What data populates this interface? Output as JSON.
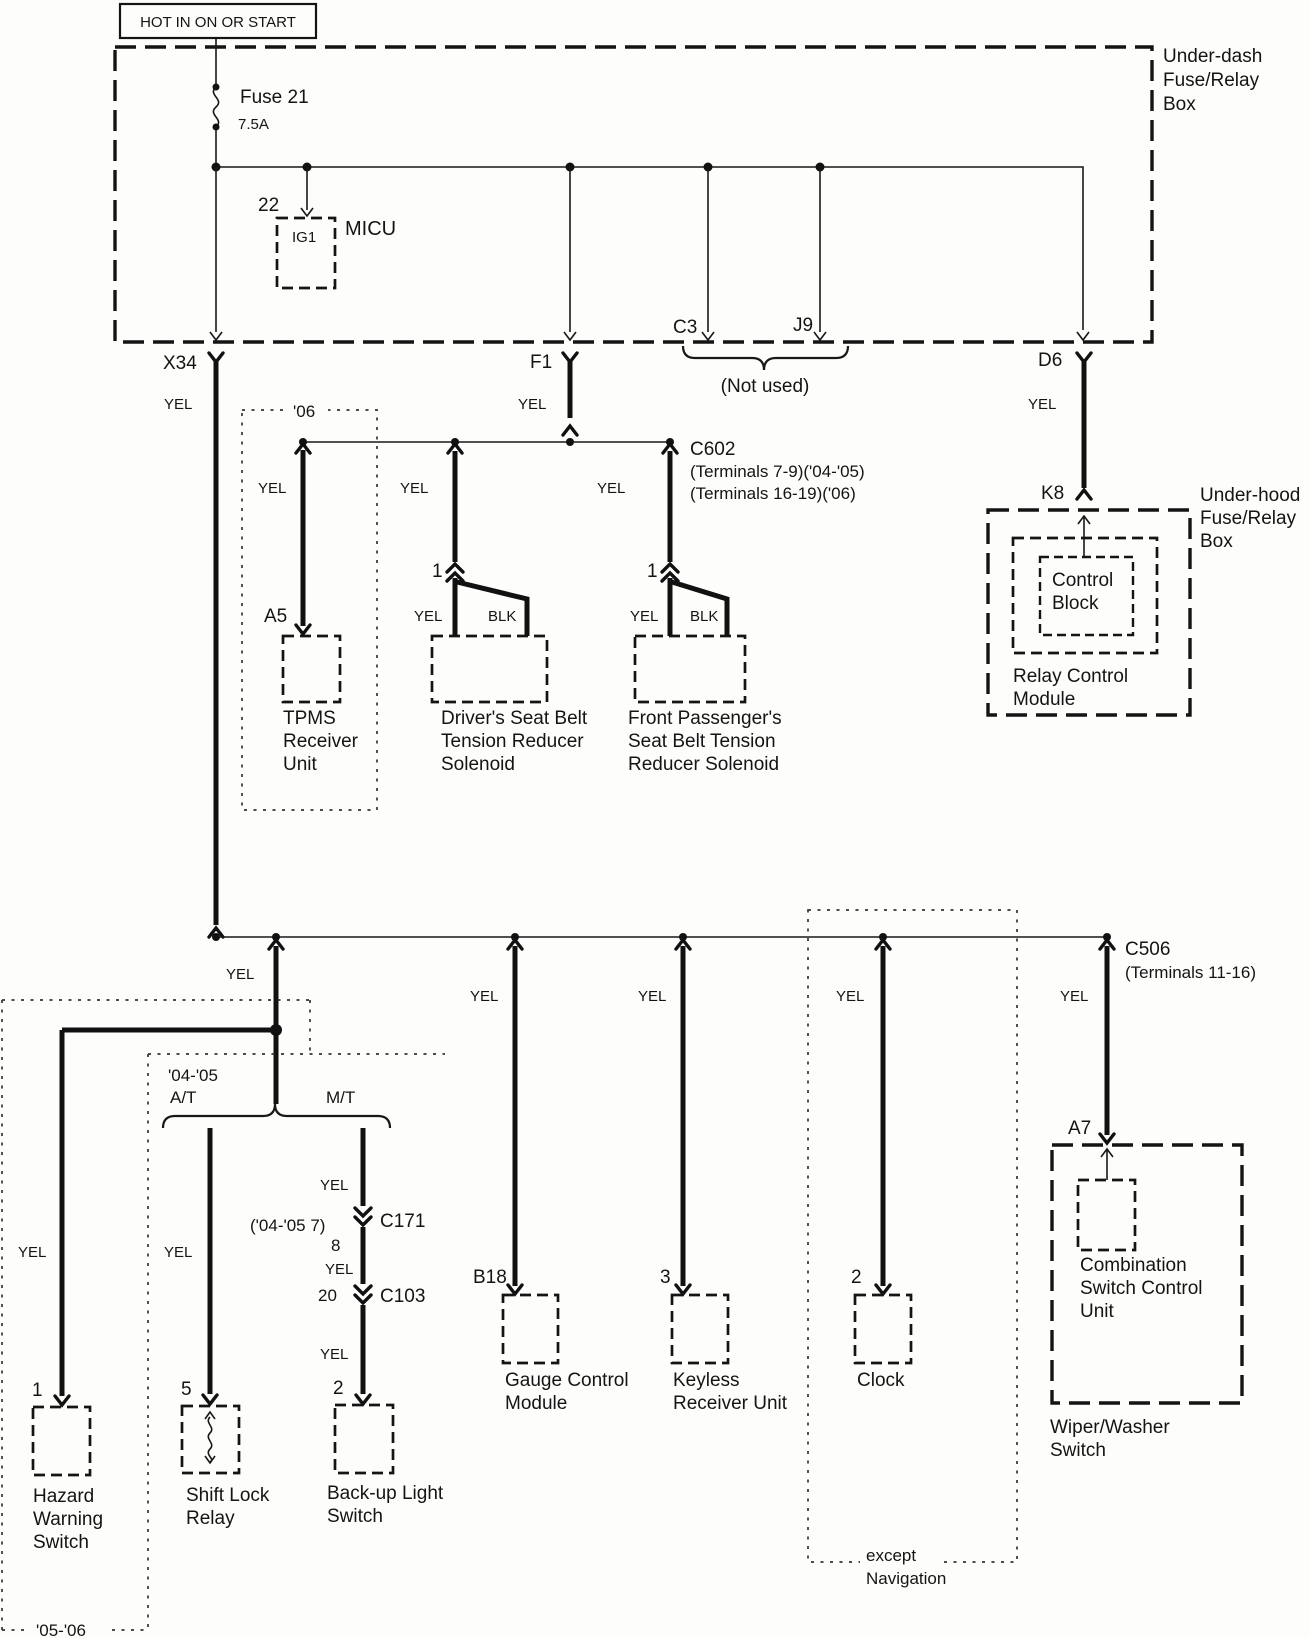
{
  "labels": {
    "yel": "YEL",
    "blk": "BLK"
  },
  "power": {
    "hot": "HOT IN ON OR START"
  },
  "underdash": {
    "n1": "Under-dash",
    "n2": "Fuse/Relay",
    "n3": "Box",
    "fuse_name": "Fuse 21",
    "fuse_rating": "7.5A",
    "micu_pin": "22",
    "micu_cavity": "IG1",
    "micu_name": "MICU",
    "x34": "X34",
    "f1": "F1",
    "c3": "C3",
    "j9": "J9",
    "d6": "D6",
    "not_used": "(Not used)"
  },
  "year06": "'06",
  "c602": {
    "name": "C602",
    "t1": "(Terminals 7-9)('04-'05)",
    "t2": "(Terminals 16-19)('06)"
  },
  "tpms": {
    "pin": "A5",
    "l1": "TPMS",
    "l2": "Receiver",
    "l3": "Unit"
  },
  "driver": {
    "pin": "1",
    "l1": "Driver's Seat Belt",
    "l2": "Tension Reducer",
    "l3": "Solenoid"
  },
  "passenger": {
    "pin": "1",
    "l1": "Front Passenger's",
    "l2": "Seat Belt Tension",
    "l3": "Reducer Solenoid"
  },
  "underhood": {
    "k8": "K8",
    "n1": "Under-hood",
    "n2": "Fuse/Relay",
    "n3": "Box",
    "cb1": "Control",
    "cb2": "Block",
    "m1": "Relay Control",
    "m2": "Module"
  },
  "c506": {
    "name": "C506",
    "t1": "(Terminals 11-16)"
  },
  "gauge": {
    "pin": "B18",
    "l1": "Gauge Control",
    "l2": "Module"
  },
  "keyless": {
    "pin": "3",
    "l1": "Keyless",
    "l2": "Receiver Unit"
  },
  "clock": {
    "pin": "2",
    "l1": "Clock"
  },
  "except_nav": {
    "l1": "except",
    "l2": "Navigation"
  },
  "combo": {
    "pin": "A7",
    "l1": "Combination",
    "l2": "Switch Control",
    "l3": "Unit",
    "w1": "Wiper/Washer",
    "w2": "Switch"
  },
  "hazard": {
    "pin": "1",
    "l1": "Hazard",
    "l2": "Warning",
    "l3": "Switch"
  },
  "shiftlock": {
    "pin": "5",
    "l1": "Shift Lock",
    "l2": "Relay"
  },
  "backup": {
    "pin": "2",
    "l1": "Back-up Light",
    "l2": "Switch"
  },
  "mt_connectors": {
    "c171_note": "('04-'05 7)",
    "c171": "C171",
    "p8": "8",
    "p20": "20",
    "c103": "C103"
  },
  "years": {
    "y0405": "'04-'05",
    "at": "A/T",
    "mt": "M/T",
    "y0506": "'05-'06"
  }
}
